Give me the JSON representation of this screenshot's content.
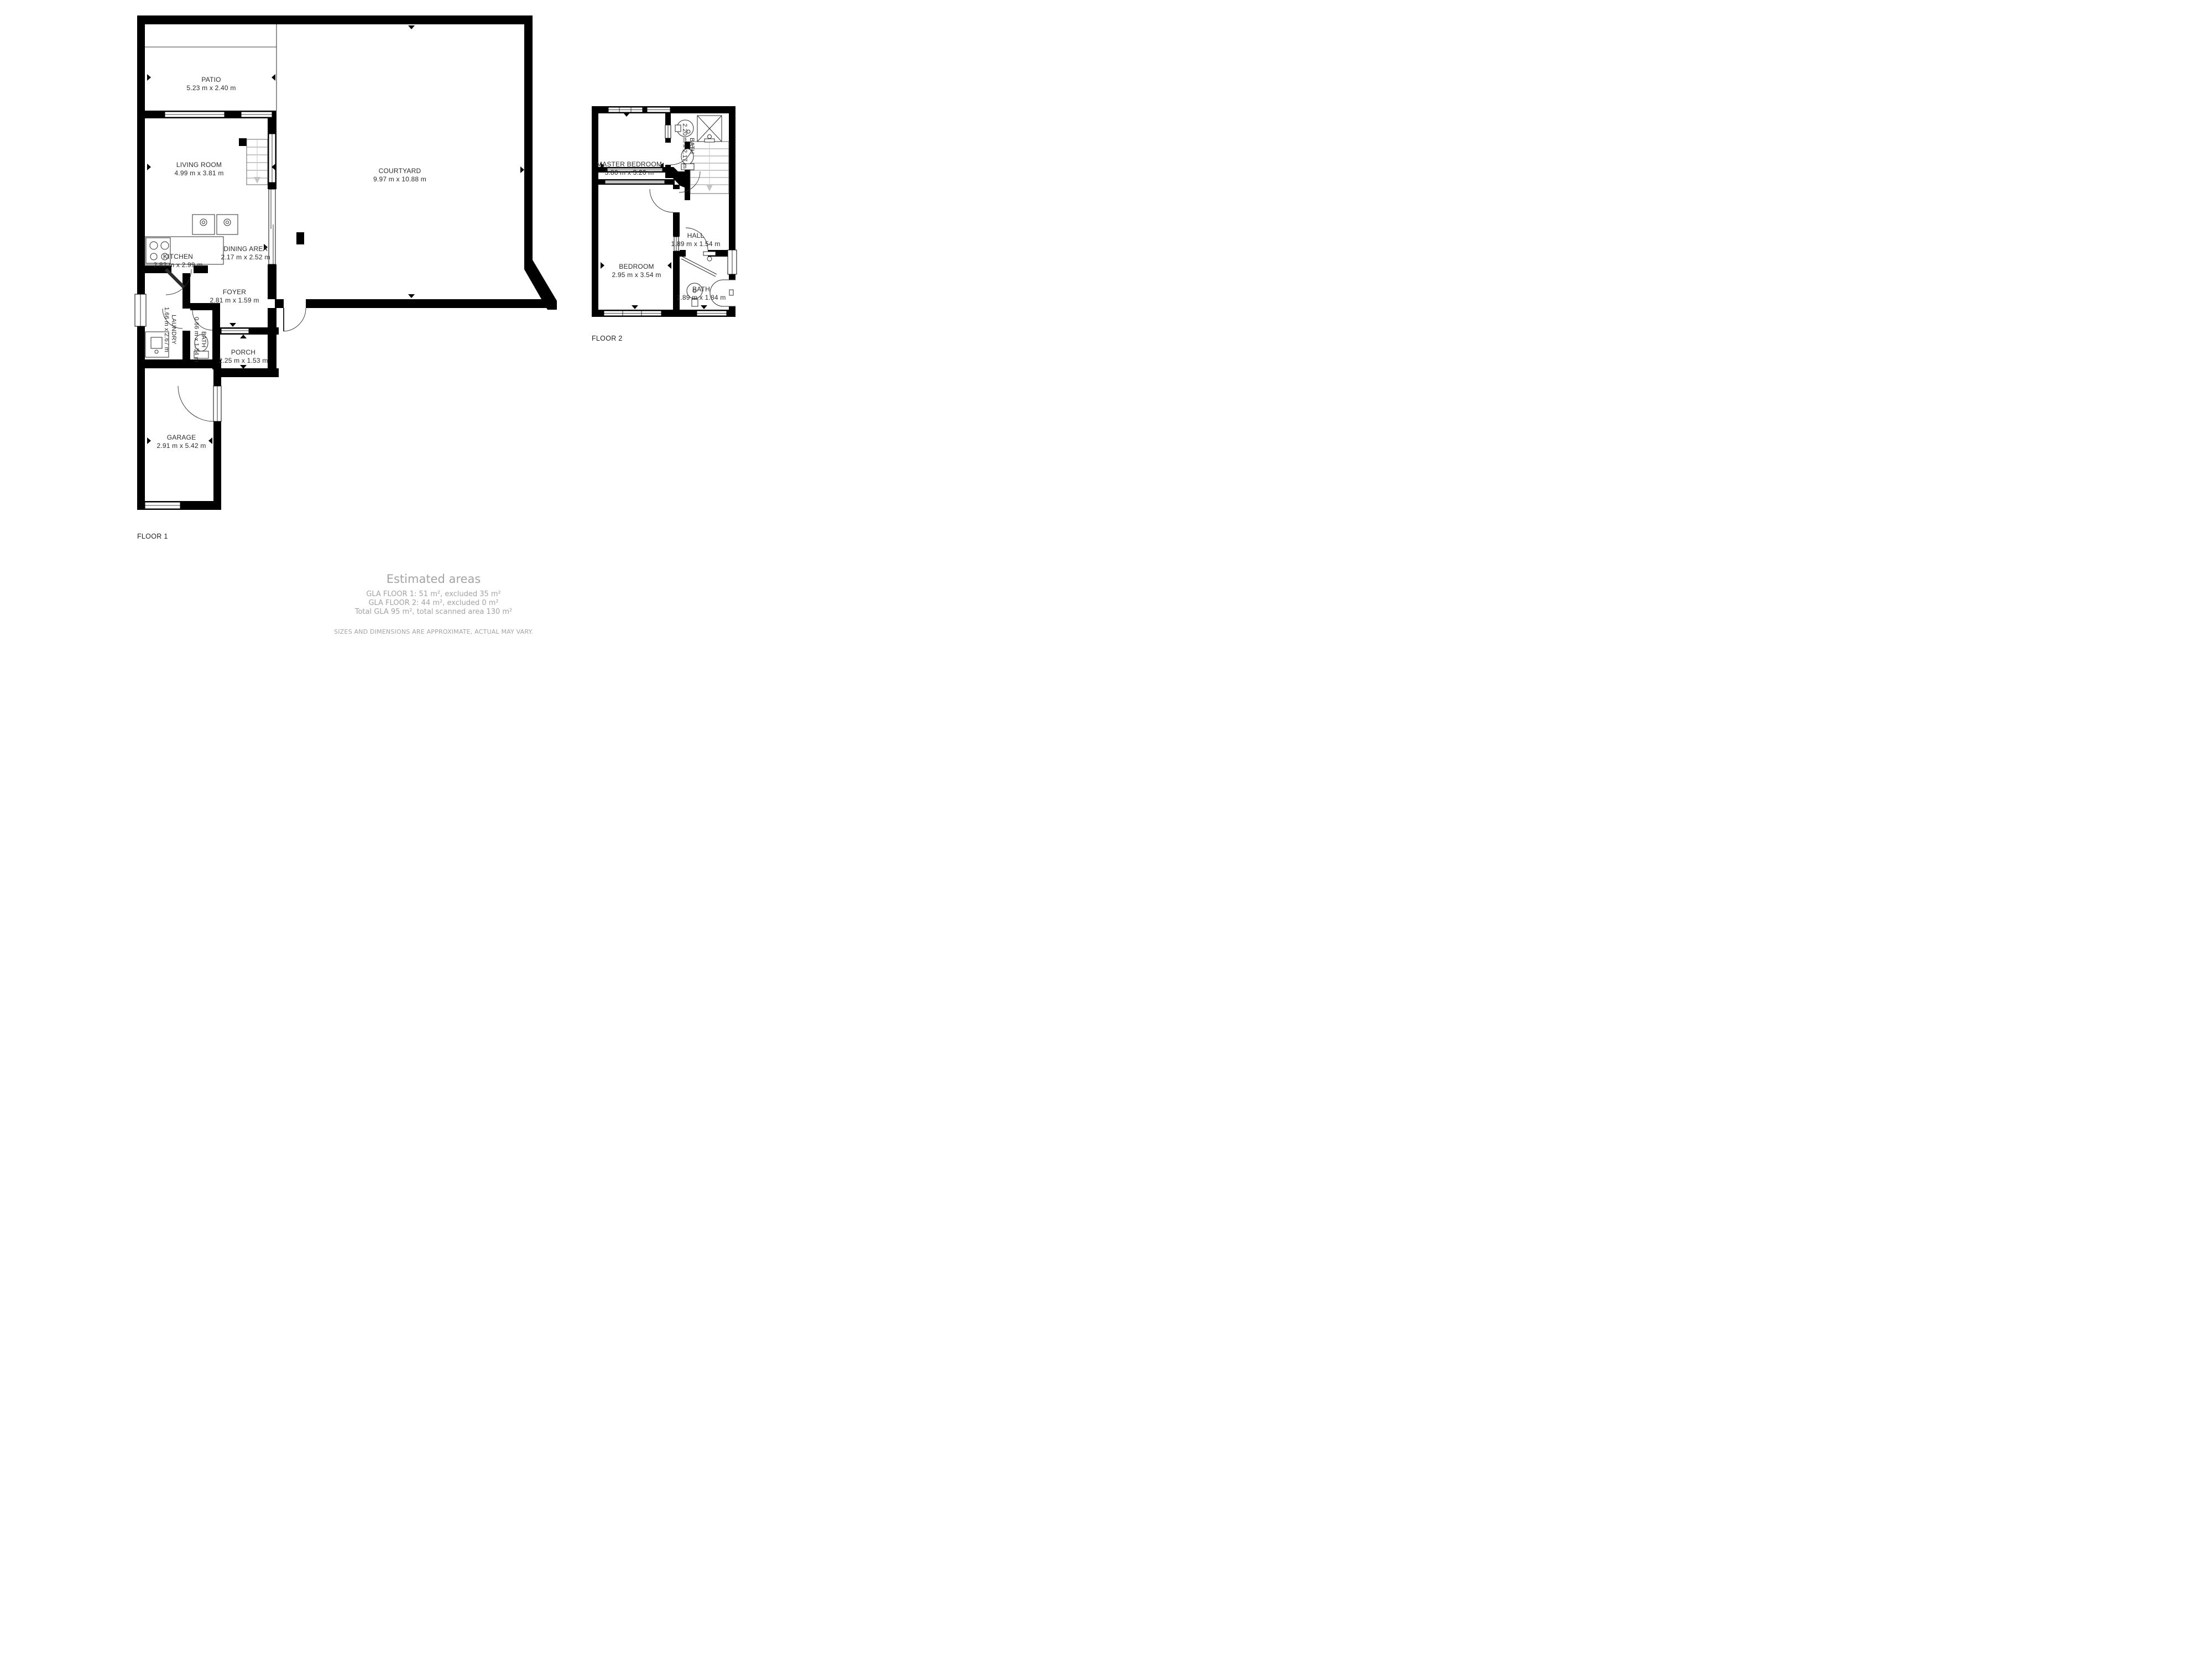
{
  "floor1": {
    "label": "FLOOR 1",
    "rooms": {
      "patio": {
        "name": "PATIO",
        "dims": "5.23 m x 2.40 m"
      },
      "living_room": {
        "name": "LIVING ROOM",
        "dims": "4.99 m x 3.81 m"
      },
      "kitchen": {
        "name": "KITCHEN",
        "dims": "2.82 m x 2.99 m"
      },
      "dining_area": {
        "name": "DINING AREA",
        "dims": "2.17 m x 2.52 m"
      },
      "courtyard": {
        "name": "COURTYARD",
        "dims": "9.97 m x 10.88 m"
      },
      "foyer": {
        "name": "FOYER",
        "dims": "2.81 m x 1.59 m"
      },
      "laundry": {
        "name": "LAUNDRY",
        "dims": "1.66 m x 2.67 m"
      },
      "bath": {
        "name": "BATH",
        "dims": "0.66 m x 1.54 m"
      },
      "porch": {
        "name": "PORCH",
        "dims": "2.25 m x 1.53 m"
      },
      "garage": {
        "name": "GARAGE",
        "dims": "2.91 m x 5.42 m"
      }
    }
  },
  "floor2": {
    "label": "FLOOR 2",
    "rooms": {
      "master_bedroom": {
        "name": "MASTER BEDROOM",
        "dims": "3.86 m x 3.20 m"
      },
      "bath_top": {
        "name": "BATH",
        "dims": "2.20 m x 2.17 m"
      },
      "hall": {
        "name": "HALL",
        "dims": "1.89 m x 1.54 m"
      },
      "bedroom": {
        "name": "BEDROOM",
        "dims": "2.95 m x 3.54 m"
      },
      "bath_bottom": {
        "name": "BATH",
        "dims": "1.89 m x 1.84 m"
      }
    }
  },
  "summary": {
    "title": "Estimated areas",
    "lines": [
      "GLA FLOOR 1: 51 m², excluded 35 m²",
      "GLA FLOOR 2: 44 m², excluded 0 m²",
      "Total GLA 95 m², total scanned area 130 m²"
    ],
    "disclaimer": "SIZES AND DIMENSIONS ARE APPROXIMATE, ACTUAL MAY VARY."
  },
  "colors": {
    "wall": "#000000",
    "label_text": "#2b2b2b",
    "muted_text": "#a3a3a3",
    "background": "#ffffff"
  }
}
